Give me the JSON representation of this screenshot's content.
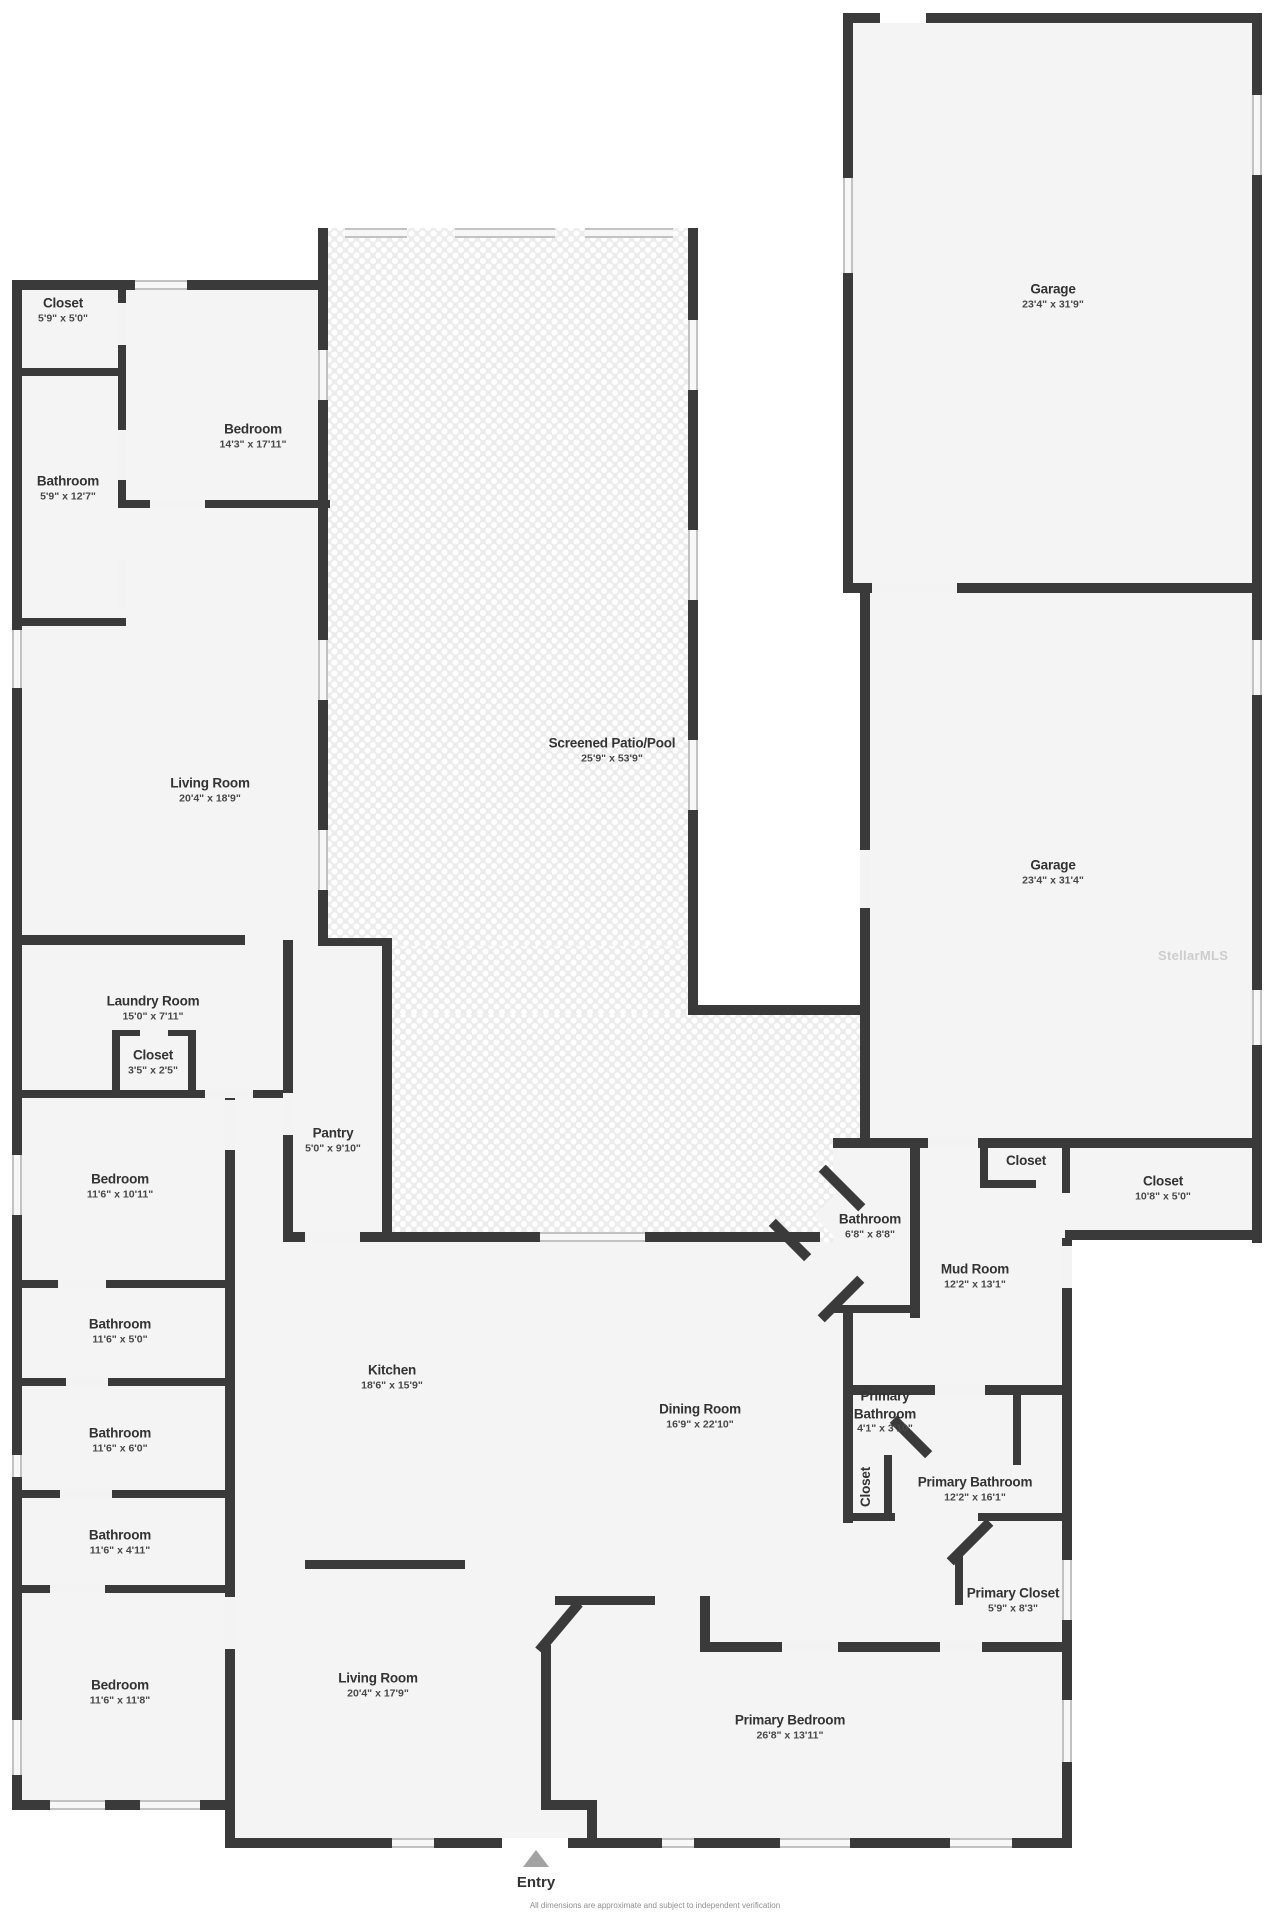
{
  "rooms": [
    {
      "name": "Closet",
      "dims": "5'9\" x 5'0\""
    },
    {
      "name": "Bathroom",
      "dims": "5'9\" x 12'7\""
    },
    {
      "name": "Bedroom",
      "dims": "14'3\" x 17'11\""
    },
    {
      "name": "Garage",
      "dims": "23'4\" x 31'9\""
    },
    {
      "name": "Screened Patio/Pool",
      "dims": "25'9\" x 53'9\""
    },
    {
      "name": "Living Room",
      "dims": "20'4\" x 18'9\""
    },
    {
      "name": "Garage",
      "dims": "23'4\" x 31'4\""
    },
    {
      "name": "Laundry Room",
      "dims": "15'0\" x 7'11\""
    },
    {
      "name": "Closet",
      "dims": "3'5\" x 2'5\""
    },
    {
      "name": "Bedroom",
      "dims": "11'6\" x 10'11\""
    },
    {
      "name": "Pantry",
      "dims": "5'0\" x 9'10\""
    },
    {
      "name": "Bathroom",
      "dims": "6'8\" x 8'8\""
    },
    {
      "name": "Mud Room",
      "dims": "12'2\" x 13'1\""
    },
    {
      "name": "Closet",
      "dims": ""
    },
    {
      "name": "Closet",
      "dims": "10'8\" x 5'0\""
    },
    {
      "name": "Bathroom",
      "dims": "11'6\" x 5'0\""
    },
    {
      "name": "Kitchen",
      "dims": "18'6\" x 15'9\""
    },
    {
      "name": "Dining Room",
      "dims": "16'9\" x 22'10\""
    },
    {
      "name": "Bathroom",
      "dims": "11'6\" x 6'0\""
    },
    {
      "name": "Primary Bathroom",
      "dims": "4'1\" x 3'10\""
    },
    {
      "name": "Closet",
      "dims": ""
    },
    {
      "name": "Primary Bathroom",
      "dims": "12'2\" x 16'1\""
    },
    {
      "name": "Bathroom",
      "dims": "11'6\" x 4'11\""
    },
    {
      "name": "Primary Closet",
      "dims": "5'9\" x 8'3\""
    },
    {
      "name": "Bedroom",
      "dims": "11'6\" x 11'8\""
    },
    {
      "name": "Living Room",
      "dims": "20'4\" x 17'9\""
    },
    {
      "name": "Primary Bedroom",
      "dims": "26'8\" x 13'11\""
    }
  ],
  "entry": {
    "label": "Entry"
  },
  "watermark": "StellarMLS",
  "disclaimer": "All dimensions are approximate and subject to independent verification",
  "colors": {
    "wall": "#3a3a3a",
    "room_fill": "#f4f4f4",
    "patio_fill": "#ececec",
    "window_frame": "#c2c2c2",
    "entry_arrow": "#a3a3a3",
    "label_text": "#333333"
  }
}
